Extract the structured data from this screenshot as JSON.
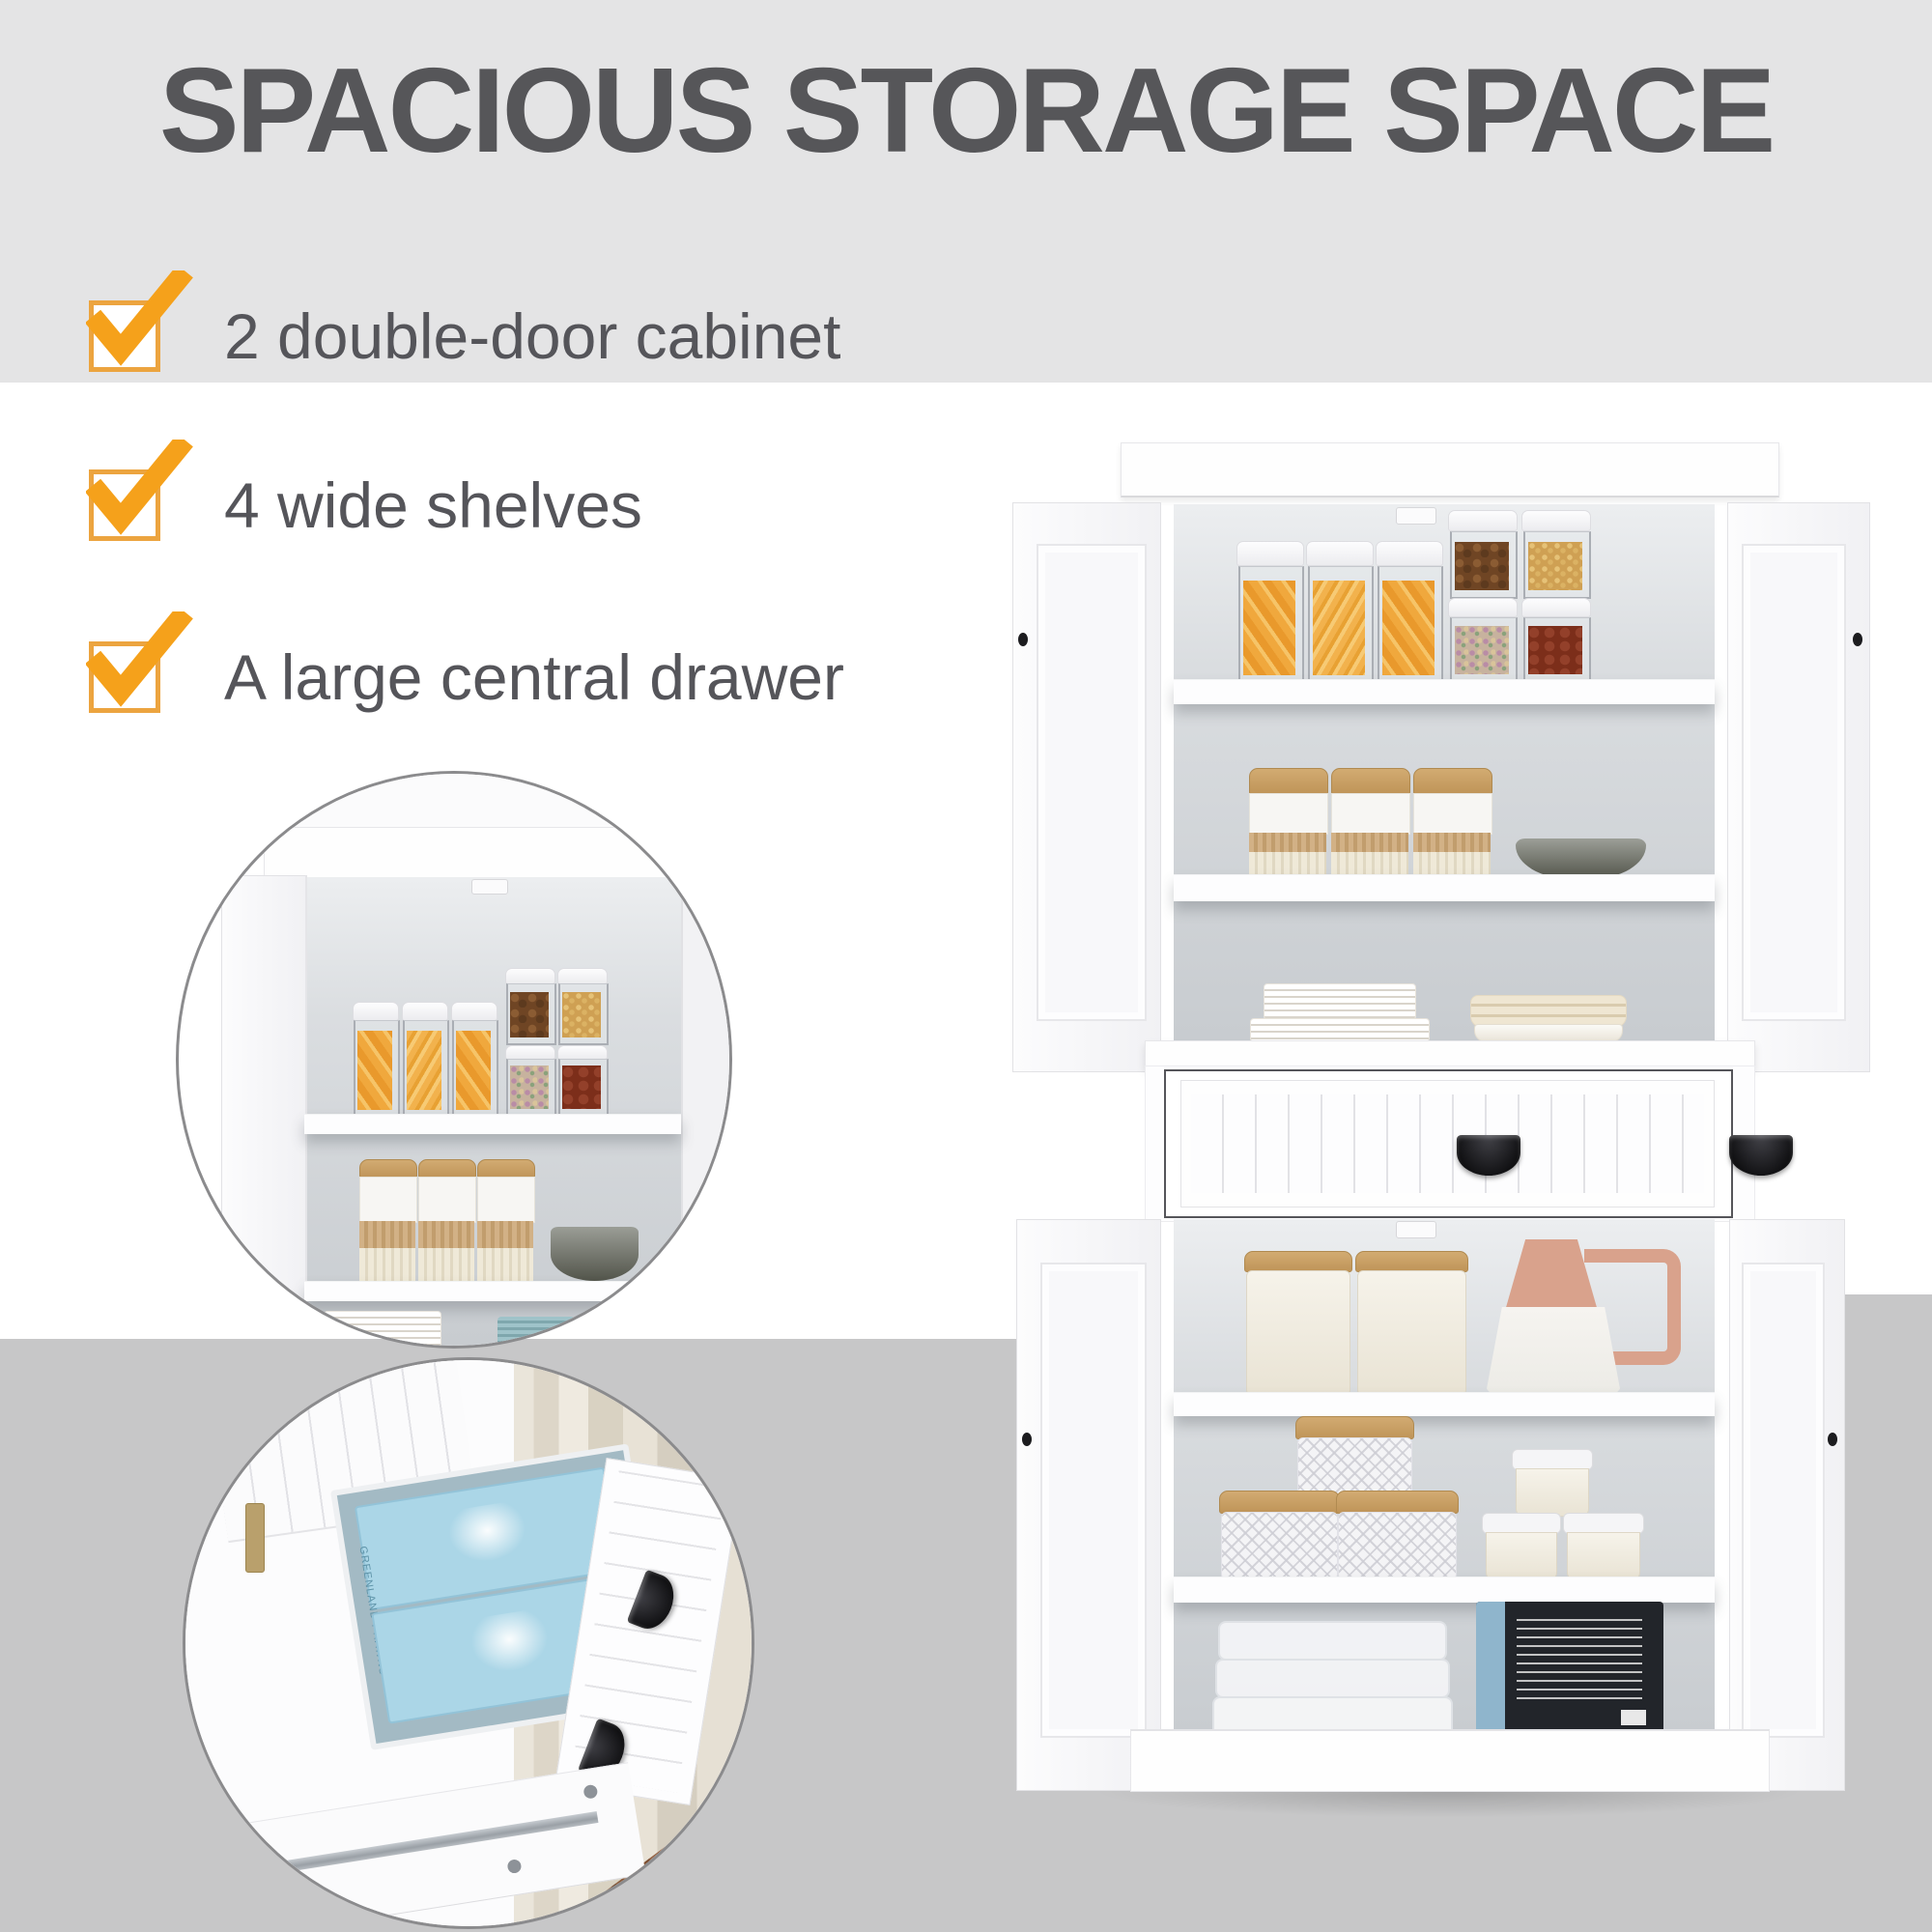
{
  "title": "SPACIOUS STORAGE SPACE",
  "features": [
    {
      "label": "2 double-door cabinet"
    },
    {
      "label": "4 wide shelves"
    },
    {
      "label": "A large central drawer"
    }
  ],
  "inset_drawer": {
    "box_label_top": "GREENLAND PRAWNS",
    "box_label_front": "POLAR SEAFOOD GREENLAND"
  },
  "colors": {
    "accent_orange": "#F5A11B",
    "checkbox_border": "#ECA43F",
    "heading_gray": "#565659",
    "body_text_gray": "#55555A",
    "top_band_gray": "#E4E4E5",
    "bottom_band_gray": "#C7C7C8"
  }
}
